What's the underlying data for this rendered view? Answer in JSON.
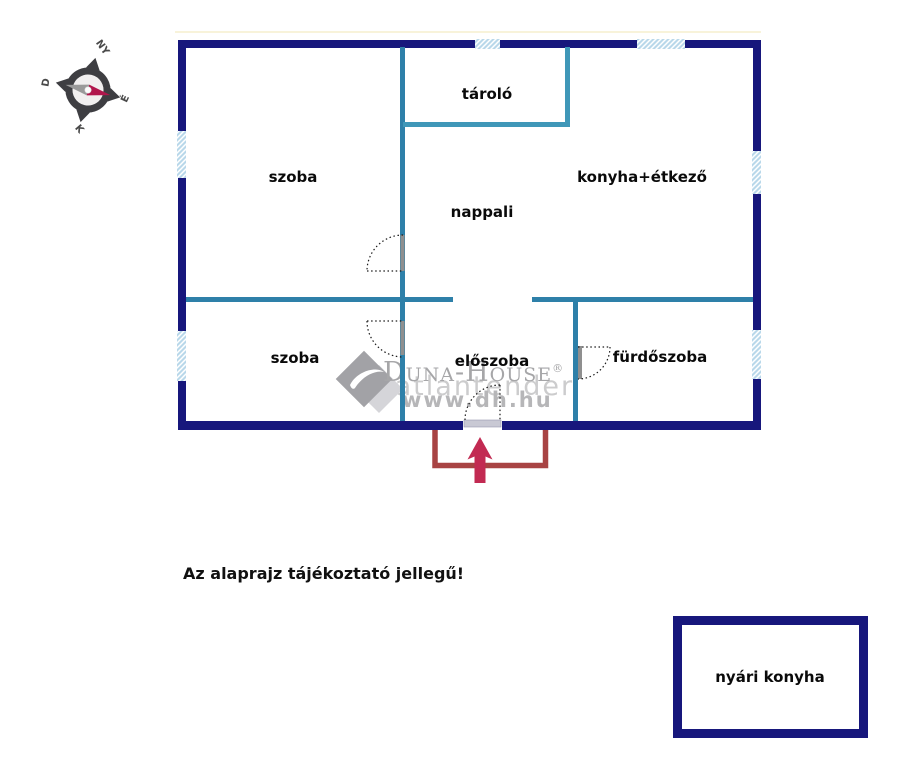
{
  "disclaimer": "Az alaprajz tájékoztató jellegű!",
  "rooms": {
    "szoba_top": "szoba",
    "tarolo": "tároló",
    "konyha_etkezo": "konyha+étkező",
    "nappali": "nappali",
    "szoba_bottom": "szoba",
    "eloszoba": "előszoba",
    "furdoszoba": "fürdőszoba",
    "nyari_konyha": "nyári konyha"
  },
  "compass": {
    "west": "NY",
    "south": "D",
    "north": "É",
    "east": "K"
  },
  "watermark": {
    "brand": "Duna-House",
    "reg": "®",
    "tagline": "igatlantender",
    "url": "www.dh.hu"
  },
  "colors": {
    "outer_wall": "#17177c",
    "inner_wall": "#2e80a9",
    "tarolo_wall": "#3f97b8",
    "window_fill": "#b9d8ea",
    "door_leaf": "#8f8f8f",
    "porch_red": "#a84343",
    "arrow_red": "#c22a52",
    "compass_ring": "#3e3e42",
    "compass_needle": "#b1164c",
    "watermark_gray": "#a6a6a8"
  }
}
